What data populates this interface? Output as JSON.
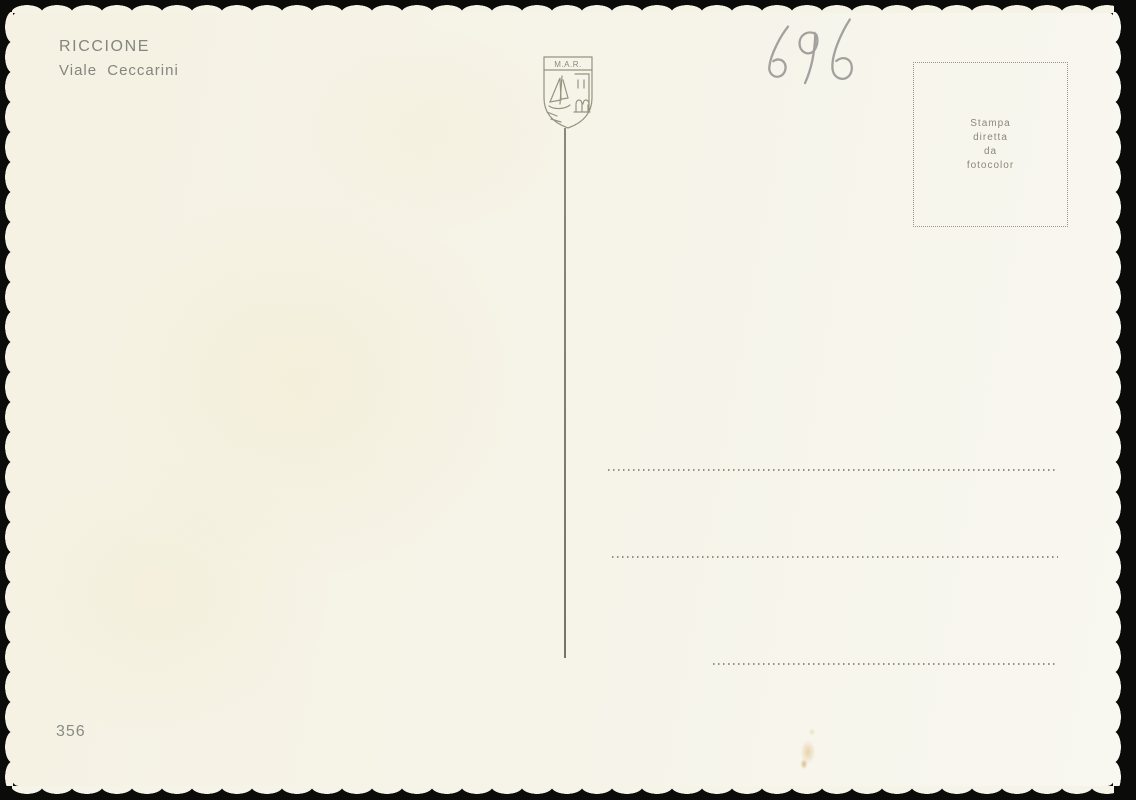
{
  "postcard": {
    "location_title": "RICCIONE",
    "location_subtitle": "Viale Ceccarini",
    "handwritten_number": "696",
    "emblem_text": "M.A.R.",
    "stamp_box": {
      "lines": [
        "Stampa",
        "diretta",
        "da",
        "fotocolor"
      ]
    },
    "catalog_number": "356",
    "colors": {
      "paper": "#f6f4e9",
      "printed_ink": "#85867f",
      "pencil": "#8d8d8b",
      "emblem_ink": "#97937f",
      "dotted_ink": "#95907e",
      "scan_background": "#0b0b09"
    }
  }
}
